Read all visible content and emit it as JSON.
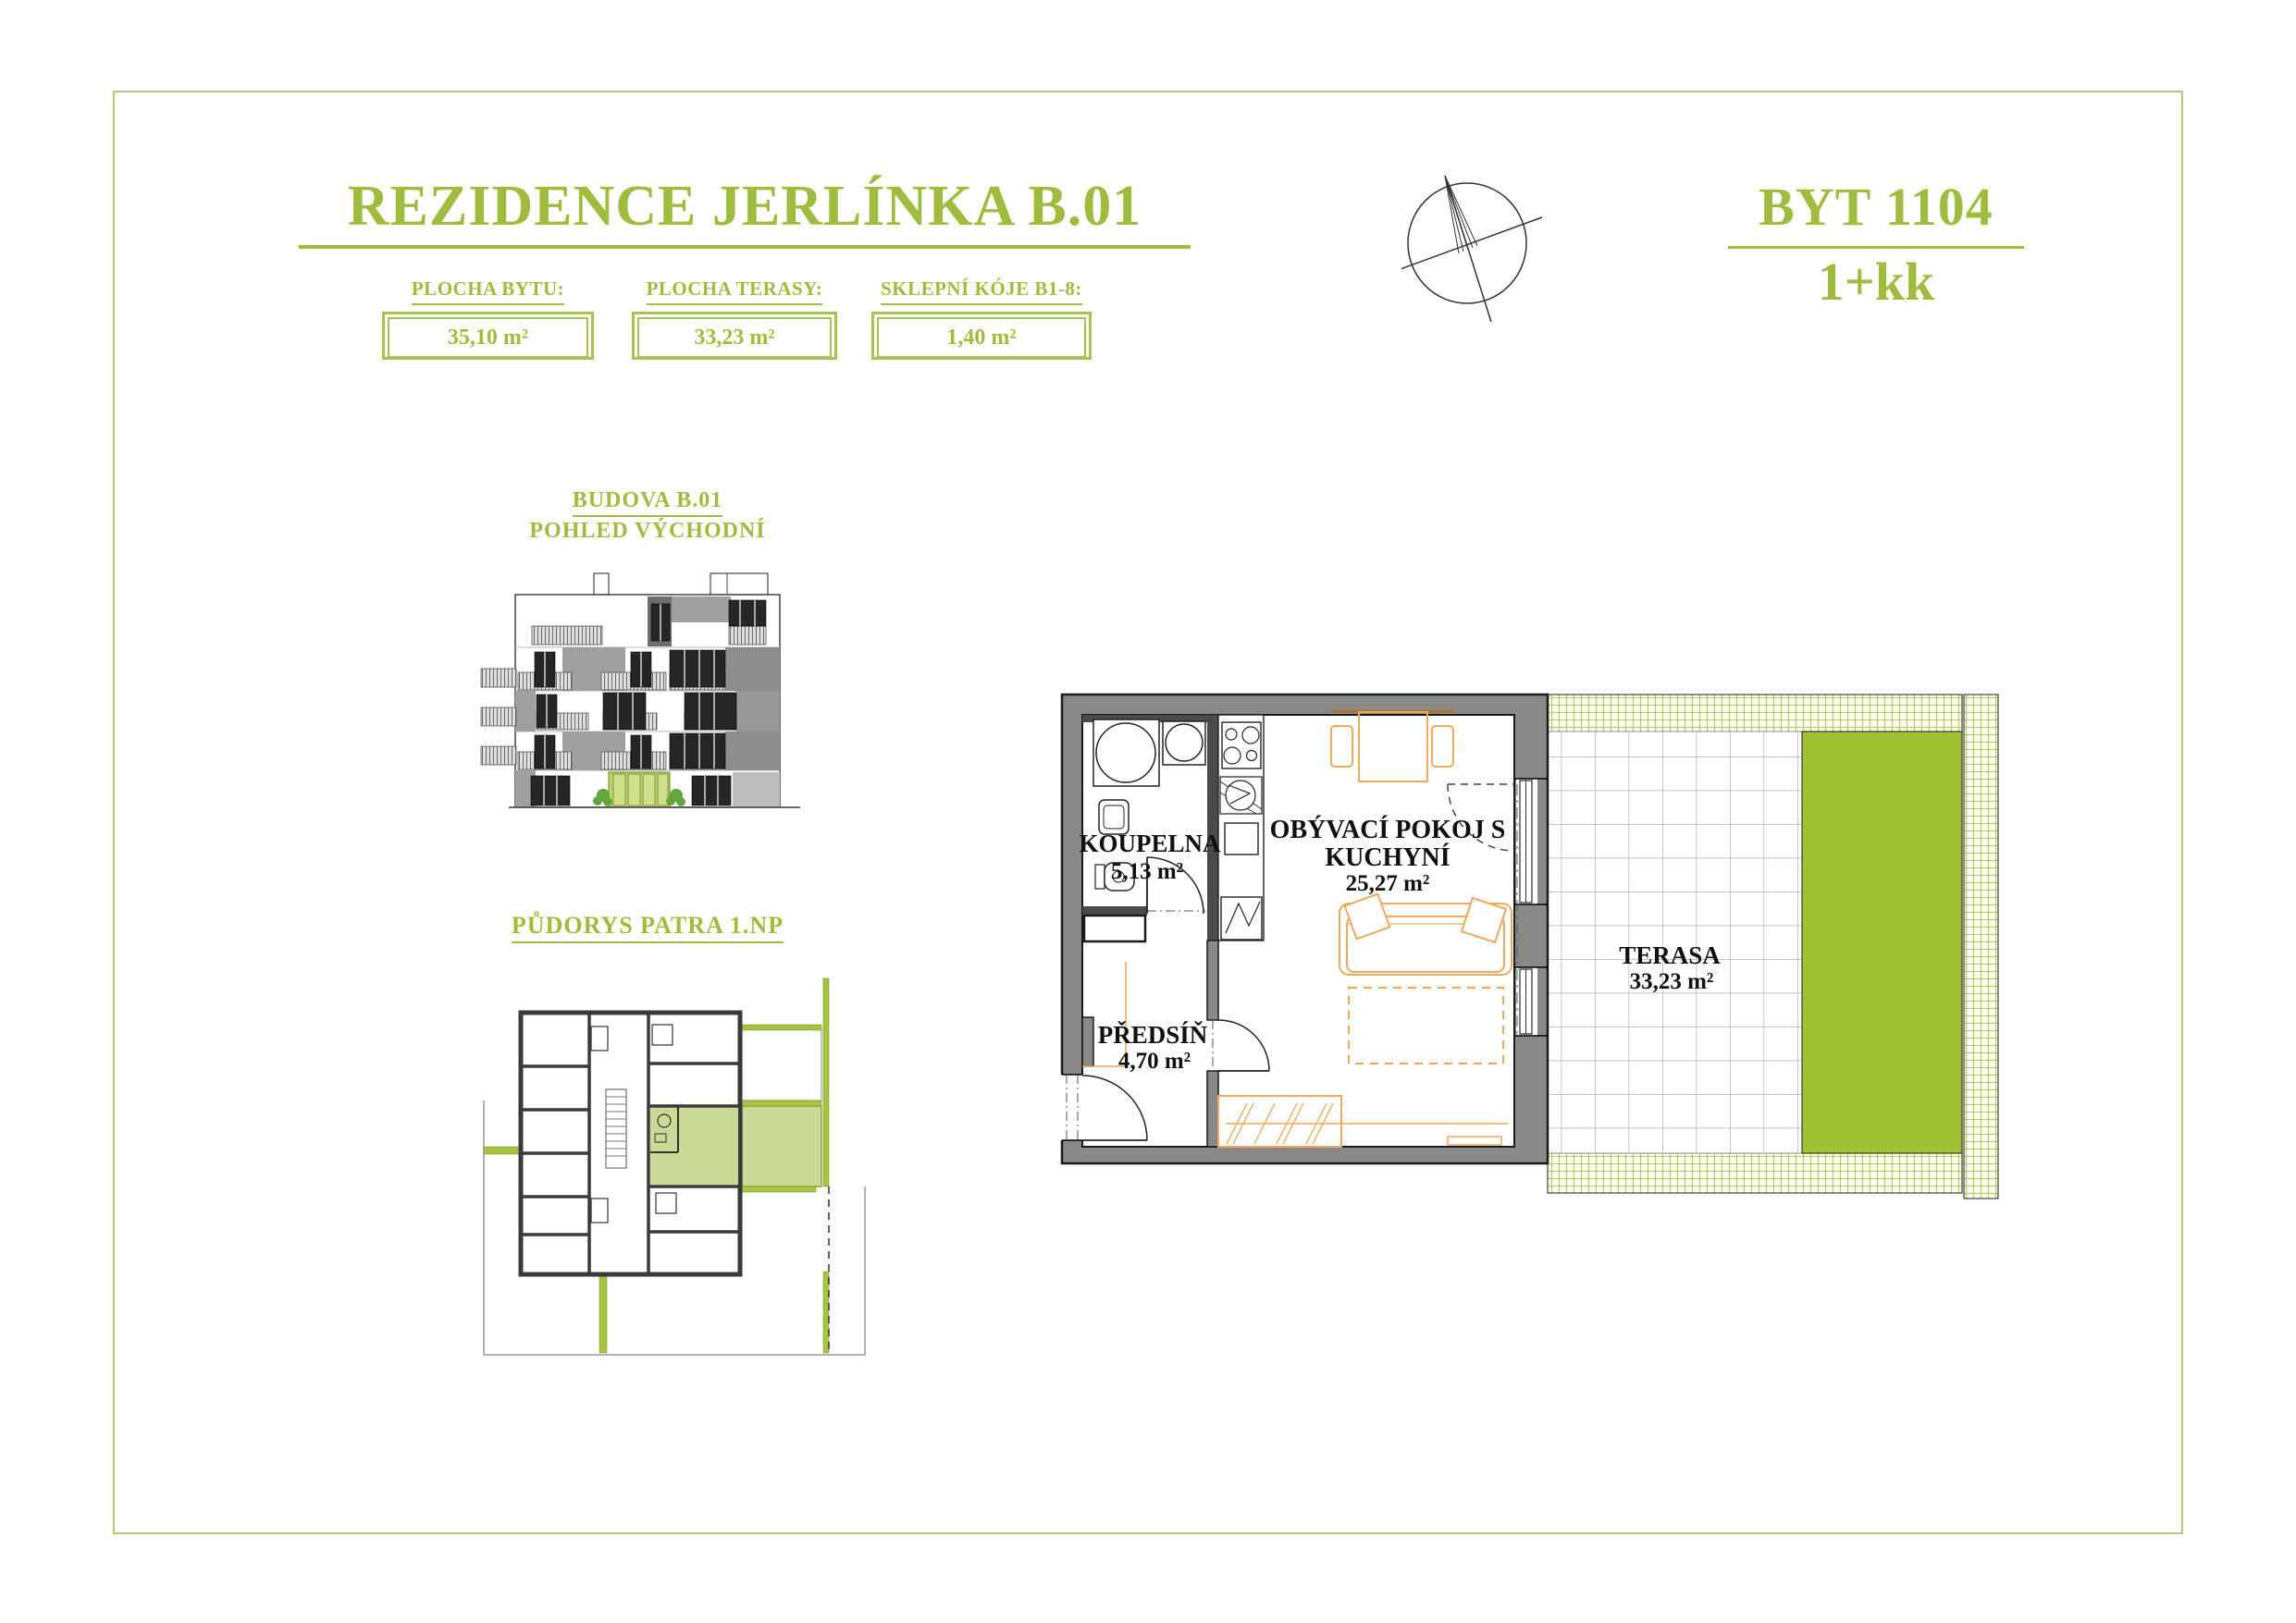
{
  "colors": {
    "accent_green": "#9fbc3e",
    "terrace_green": "#a0c132",
    "highlight_green": "#cbd996",
    "hatch_green": "#b9cd5b",
    "furniture_orange": "#efa95e",
    "wall_gray": "#898989"
  },
  "header": {
    "title": "REZIDENCE JERLÍNKA B.01"
  },
  "unit": {
    "number": "BYT 1104",
    "layout": "1+kk"
  },
  "stats": [
    {
      "label": "PLOCHA BYTU:",
      "value": "35,10 m²"
    },
    {
      "label": "PLOCHA TERASY:",
      "value": "33,23 m²"
    },
    {
      "label": "SKLEPNÍ KÓJE B1-8:",
      "value": "1,40 m²"
    }
  ],
  "elevation": {
    "title": "BUDOVA  B.01",
    "subtitle": "POHLED VÝCHODNÍ"
  },
  "overview": {
    "title": "PŮDORYS PATRA 1.NP"
  },
  "floorplan": {
    "rooms": {
      "bathroom": {
        "name": "KOUPELNA",
        "area": "5,13 m²"
      },
      "hall": {
        "name": "PŘEDSÍŇ",
        "area": "4,70 m²"
      },
      "living": {
        "name_line1": "OBÝVACÍ POKOJ S",
        "name_line2": "KUCHYNÍ",
        "area": "25,27 m²"
      },
      "terrace": {
        "name": "TERASA",
        "area": "33,23 m²"
      }
    }
  }
}
